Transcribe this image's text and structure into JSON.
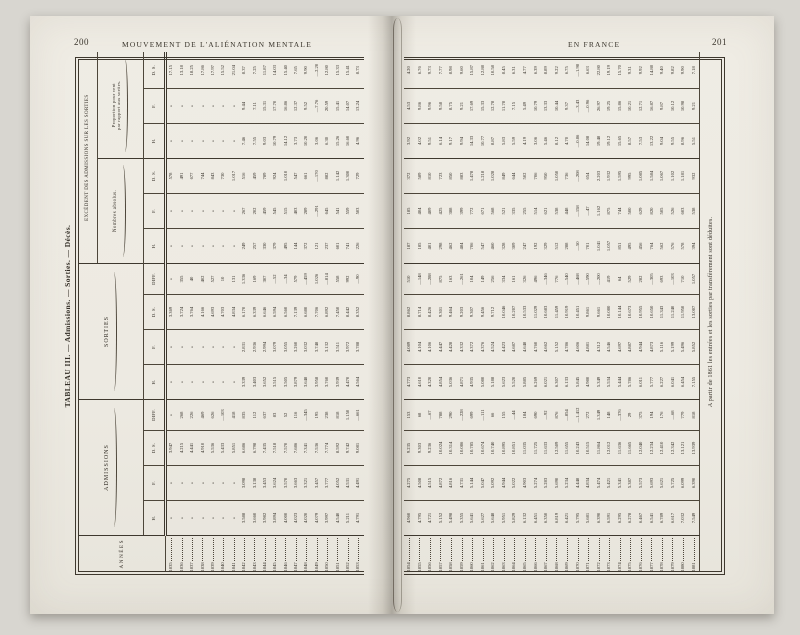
{
  "page": {
    "left_folio": "200",
    "left_running_title": "MOUVEMENT DE L'ALIÉNATION MENTALE",
    "right_running_title": "EN FRANCE",
    "right_folio": "201"
  },
  "table": {
    "title": "TABLEAU III. — Admissions. — Sorties. — Décès.",
    "footnote": "A partir de 1861 les entrées et les sorties par transfèrement sont déduites.",
    "missing_mark": "»",
    "columns": {
      "annees": "ANNÉES",
      "admissions": "ADMISSIONS",
      "sorties": "SORTIES",
      "excedent": "EXCÉDENT DES ADMISSIONS SUR LES SORTIES",
      "nombres_absolus": "Nombres absolus.",
      "proportion_l1": "Proportion pour cent",
      "proportion_l2": "par rapport aux sorties.",
      "h": "H.",
      "f": "F.",
      "ds": "D. S.",
      "diff": "DIFF."
    },
    "column_order": [
      "annee",
      "adm_h",
      "adm_f",
      "adm_ds",
      "adm_diff",
      "sort_h",
      "sort_f",
      "sort_ds",
      "sort_diff",
      "exc_abs_h",
      "exc_abs_f",
      "exc_abs_ds",
      "exc_prop_h",
      "exc_prop_f",
      "exc_prop_ds"
    ],
    "left_rows": [
      [
        "1835",
        "»",
        "»",
        "3.947",
        "»",
        "»",
        "»",
        "3.369",
        "»",
        "»",
        "»",
        "578",
        "»",
        "»",
        "17.15"
      ],
      [
        "1836",
        "»",
        "»",
        "4.215",
        "268",
        "»",
        "»",
        "3.724",
        "355",
        "»",
        "»",
        "491",
        "»",
        "»",
        "13.18"
      ],
      [
        "1837",
        "»",
        "»",
        "4.441",
        "226",
        "»",
        "»",
        "3.764",
        "40",
        "»",
        "»",
        "677",
        "»",
        "»",
        "18.25"
      ],
      [
        "1838",
        "»",
        "»",
        "4.910",
        "469",
        "»",
        "»",
        "4.166",
        "402",
        "»",
        "»",
        "744",
        "»",
        "»",
        "17.86"
      ],
      [
        "1839",
        "»",
        "»",
        "5.536",
        "626",
        "»",
        "»",
        "4.693",
        "527",
        "»",
        "»",
        "843",
        "»",
        "»",
        "17.97"
      ],
      [
        "1840",
        "»",
        "»",
        "5.433",
        "-103",
        "»",
        "»",
        "4.703",
        "10",
        "»",
        "»",
        "730",
        "»",
        "»",
        "15.52"
      ],
      [
        "1841",
        "»",
        "»",
        "5.851",
        "418",
        "»",
        "»",
        "4.834",
        "131",
        "»",
        "»",
        "1.017",
        "»",
        "»",
        "21.04"
      ],
      [
        "1842",
        "3.588",
        "3.098",
        "6.686",
        "835",
        "3.339",
        "2.831",
        "6.170",
        "1.336",
        "249",
        "267",
        "516",
        "7.46",
        "9.44",
        "8.37"
      ],
      [
        "1843",
        "3.660",
        "3.138",
        "6.798",
        "112",
        "3.403",
        "2.936",
        "6.339",
        "169",
        "257",
        "202",
        "459",
        "7.55",
        "7.11",
        "7.25"
      ],
      [
        "1844",
        "3.982",
        "3.453",
        "7.435",
        "637",
        "3.652",
        "2.994",
        "6.646",
        "307",
        "330",
        "459",
        "789",
        "9.03",
        "15.31",
        "11.87"
      ],
      [
        "1845",
        "3.894",
        "3.624",
        "7.518",
        "83",
        "3.515",
        "3.079",
        "6.594",
        "-52",
        "379",
        "545",
        "924",
        "10.79",
        "17.70",
        "14.03"
      ],
      [
        "1846",
        "4.000",
        "3.570",
        "7.570",
        "52",
        "3.505",
        "3.055",
        "6.560",
        "-34",
        "495",
        "515",
        "1.010",
        "14.12",
        "16.86",
        "15.40"
      ],
      [
        "1847",
        "4.023",
        "3.663",
        "7.686",
        "116",
        "3.879",
        "3.260",
        "7.139",
        "579",
        "144",
        "403",
        "547",
        "3.73",
        "12.37",
        "7.65"
      ],
      [
        "1848",
        "4.020",
        "3.321",
        "7.341",
        "-345",
        "3.648",
        "3.032",
        "6.680",
        "-459",
        "372",
        "289",
        "661",
        "10.20",
        "9.52",
        "9.90"
      ],
      [
        "1849",
        "4.079",
        "3.457",
        "7.536",
        "195",
        "3.958",
        "3.748",
        "7.706",
        "1.026",
        "121",
        "-291",
        "-170",
        "3.06",
        "-7.76",
        "-2.20"
      ],
      [
        "1850",
        "3.997",
        "3.777",
        "7.774",
        "238",
        "3.760",
        "3.132",
        "6.892",
        "-814",
        "237",
        "645",
        "882",
        "6.30",
        "20.59",
        "12.80"
      ],
      [
        "1851",
        "4.540",
        "4.052",
        "8.592",
        "818",
        "3.939",
        "3.511",
        "7.450",
        "558",
        "601",
        "541",
        "1.142",
        "15.26",
        "15.41",
        "15.33"
      ],
      [
        "1852",
        "5.211",
        "4.531",
        "9.742",
        "1.150",
        "4.470",
        "3.972",
        "8.442",
        "992",
        "741",
        "559",
        "1.300",
        "16.60",
        "14.07",
        "15.41"
      ],
      [
        "1853",
        "4.791",
        "4.491",
        "9.081",
        "-661",
        "4.564",
        "3.788",
        "8.352",
        "-90",
        "226",
        "503",
        "729",
        "4.96",
        "13.24",
        "8.73"
      ]
    ],
    "right_rows": [
      [
        "1854",
        "4.960",
        "4.275",
        "9.235",
        "153",
        "4.773",
        "4.089",
        "8.862",
        "510",
        "187",
        "185",
        "372",
        "3.92",
        "4.53",
        "4.20"
      ],
      [
        "1855",
        "4.795",
        "4.508",
        "9.303",
        "68",
        "4.610",
        "4.104",
        "8.714",
        "-148",
        "185",
        "404",
        "589",
        "4.02",
        "9.86",
        "6.76"
      ],
      [
        "1856",
        "4.721",
        "4.515",
        "9.236",
        "-67",
        "4.320",
        "4.106",
        "8.426",
        "-288",
        "401",
        "409",
        "810",
        "9.51",
        "9.96",
        "9.73"
      ],
      [
        "1857",
        "5.152",
        "4.872",
        "10.024",
        "788",
        "4.854",
        "4.447",
        "9.301",
        "875",
        "298",
        "425",
        "723",
        "6.14",
        "9.58",
        "7.77"
      ],
      [
        "1858",
        "5.498",
        "4.816",
        "10.314",
        "290",
        "5.036",
        "4.428",
        "9.464",
        "163",
        "462",
        "388",
        "850",
        "9.17",
        "8.75",
        "8.98"
      ],
      [
        "1859",
        "5.355",
        "4.731",
        "10.086",
        "-228",
        "4.871",
        "4.332",
        "9.203",
        "-261",
        "484",
        "399",
        "883",
        "9.94",
        "9.21",
        "9.60"
      ],
      [
        "1860",
        "5.641",
        "5.144",
        "10.785",
        "699",
        "4.935",
        "4.372",
        "9.307",
        "104",
        "706",
        "772",
        "1.478",
        "14.33",
        "17.69",
        "15.87"
      ],
      [
        "1861",
        "5.627",
        "5.047",
        "10.674",
        "-111",
        "5.080",
        "4.376",
        "9.456",
        "149",
        "547",
        "671",
        "1.218",
        "10.77",
        "15.33",
        "12.88"
      ],
      [
        "1862",
        "5.648",
        "5.092",
        "10.740",
        "66",
        "5.188",
        "4.524",
        "9.712",
        "256",
        "460",
        "568",
        "1.028",
        "8.87",
        "12.78",
        "10.58"
      ],
      [
        "1863",
        "5.951",
        "4.944",
        "10.895",
        "155",
        "5.623",
        "4.423",
        "10.046",
        "334",
        "328",
        "521",
        "849",
        "5.83",
        "11.78",
        "8.45"
      ],
      [
        "1864",
        "5.829",
        "5.022",
        "10.851",
        "-44",
        "5.520",
        "4.687",
        "10.207",
        "161",
        "309",
        "335",
        "644",
        "5.59",
        "7.15",
        "6.31"
      ],
      [
        "1865",
        "6.132",
        "4.903",
        "11.035",
        "184",
        "5.885",
        "4.648",
        "10.533",
        "326",
        "247",
        "255",
        "502",
        "4.19",
        "5.49",
        "4.77"
      ],
      [
        "1866",
        "6.451",
        "5.274",
        "11.725",
        "690",
        "6.269",
        "4.760",
        "11.029",
        "496",
        "192",
        "514",
        "706",
        "3.06",
        "10.79",
        "6.39"
      ],
      [
        "1867",
        "6.350",
        "5.283",
        "11.633",
        "-92",
        "6.021",
        "4.662",
        "10.683",
        "-346",
        "329",
        "621",
        "950",
        "5.46",
        "13.33",
        "8.89"
      ],
      [
        "1868",
        "6.819",
        "5.690",
        "12.509",
        "876",
        "6.307",
        "5.152",
        "11.459",
        "776",
        "512",
        "538",
        "1.050",
        "8.12",
        "10.44",
        "9.22"
      ],
      [
        "1869",
        "6.421",
        "5.234",
        "11.655",
        "-854",
        "6.133",
        "4.786",
        "10.919",
        "-540",
        "288",
        "448",
        "736",
        "4.70",
        "9.37",
        "6.75"
      ],
      [
        "1870",
        "5.795",
        "4.448",
        "10.243",
        "-1.412",
        "5.845",
        "4.606",
        "10.451",
        "-468",
        "-50",
        "-158",
        "-208",
        "-0.86",
        "-3.43",
        "-1.98"
      ],
      [
        "1871",
        "5.681",
        "4.834",
        "10.515",
        "272",
        "4.980",
        "4.881",
        "9.861",
        "-590",
        "701",
        "-47",
        "654",
        "14.08",
        "-0.96",
        "6.63"
      ],
      [
        "1872",
        "6.390",
        "5.474",
        "11.864",
        "1.349",
        "5.349",
        "4.312",
        "9.661",
        "-200",
        "1.041",
        "1.162",
        "2.203",
        "19.48",
        "26.97",
        "22.80"
      ],
      [
        "1873",
        "6.591",
        "5.421",
        "12.012",
        "148",
        "5.534",
        "4.546",
        "10.080",
        "419",
        "1.057",
        "875",
        "1.932",
        "19.12",
        "19.25",
        "19.19"
      ],
      [
        "1874",
        "6.295",
        "5.341",
        "11.636",
        "-376",
        "5.444",
        "4.697",
        "10.144",
        "64",
        "851",
        "744",
        "1.595",
        "15.65",
        "15.86",
        "15.70"
      ],
      [
        "1875",
        "6.278",
        "5.387",
        "11.665",
        "29",
        "5.786",
        "4.887",
        "10.673",
        "529",
        "495",
        "500",
        "995",
        "8.57",
        "10.21",
        "9.31"
      ],
      [
        "1876",
        "6.467",
        "5.573",
        "12.040",
        "375",
        "6.011",
        "4.944",
        "10.955",
        "282",
        "456",
        "629",
        "1.085",
        "7.53",
        "12.71",
        "9.92"
      ],
      [
        "1877",
        "6.541",
        "5.693",
        "12.234",
        "194",
        "5.777",
        "4.873",
        "10.650",
        "-305",
        "764",
        "820",
        "1.584",
        "13.22",
        "16.87",
        "14.88"
      ],
      [
        "1878",
        "6.789",
        "5.621",
        "12.410",
        "176",
        "6.227",
        "5.116",
        "11.343",
        "693",
        "562",
        "505",
        "1.067",
        "9.04",
        "9.87",
        "9.40"
      ],
      [
        "1879",
        "6.617",
        "5.725",
        "12.342",
        "-68",
        "6.041",
        "5.199",
        "11.240",
        "-103",
        "576",
        "526",
        "1.102",
        "9.55",
        "10.12",
        "9.82"
      ],
      [
        "1880",
        "7.032",
        "6.099",
        "13.121",
        "779",
        "6.454",
        "5.496",
        "11.950",
        "710",
        "578",
        "603",
        "1.181",
        "8.96",
        "10.98",
        "9.90"
      ],
      [
        "1881",
        "7.549",
        "6.390",
        "13.939",
        "818",
        "7.155",
        "5.852",
        "13.007",
        "1.057",
        "394",
        "538",
        "932",
        "5.51",
        "9.21",
        "7.18"
      ]
    ]
  },
  "colors": {
    "scan_background": "#d8d6d0",
    "paper": "#efece4",
    "ink": "#332e26",
    "rule": "#4d463a"
  }
}
